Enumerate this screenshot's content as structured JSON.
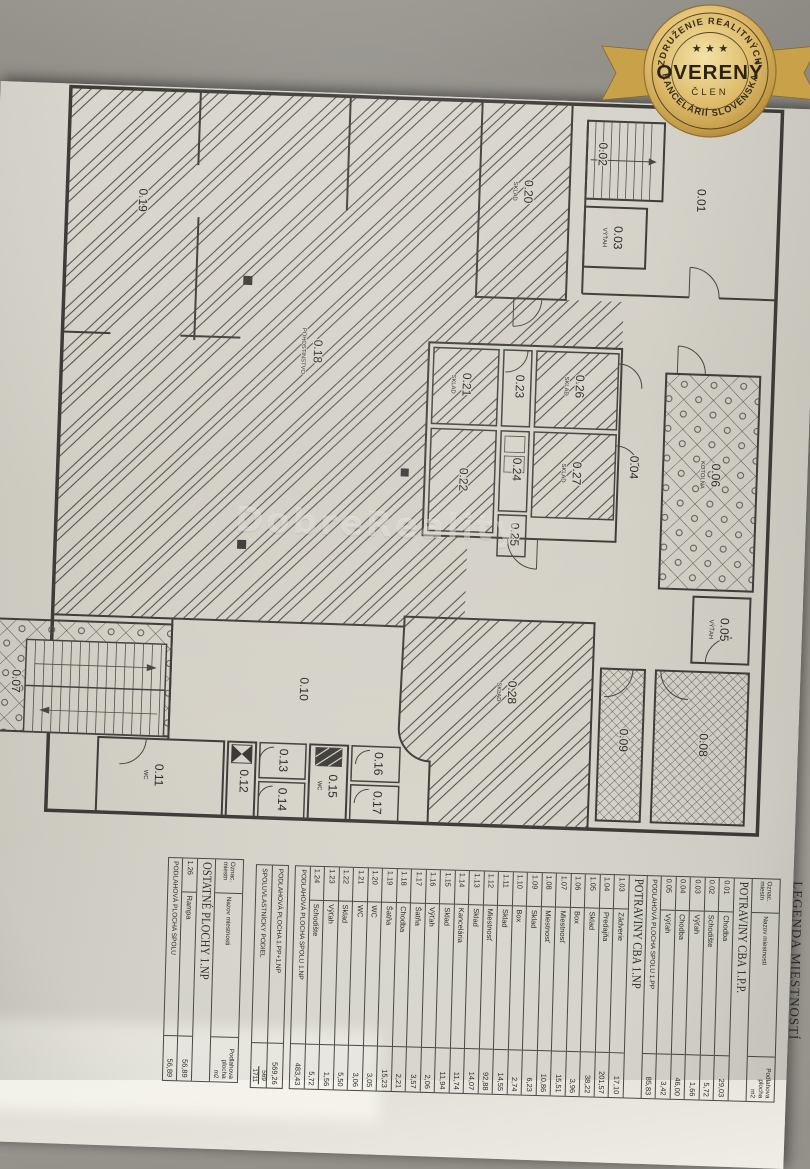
{
  "badge": {
    "arc_top": "ZDRUŽENIE REALITNÝCH",
    "stars": "★ ★ ★",
    "title": "OVERENÝ",
    "subtitle": "ČLEN",
    "arc_bottom": "KANCELÁRIÍ SLOVENSKA",
    "gold": "#d3ab56"
  },
  "watermark": "DobreReality",
  "plan": {
    "rooms": [
      {
        "label": "0.19",
        "sub": ""
      },
      {
        "label": "0.18",
        "sub": "POHOSTINSTVO"
      },
      {
        "label": "0.20",
        "sub": "SKLAD"
      },
      {
        "label": "0.02",
        "sub": ""
      },
      {
        "label": "0.03",
        "sub": "VÝŤAH"
      },
      {
        "label": "0.01",
        "sub": ""
      },
      {
        "label": "0.21",
        "sub": "SKLAD"
      },
      {
        "label": "0.23",
        "sub": ""
      },
      {
        "label": "0.26",
        "sub": "SKLAD"
      },
      {
        "label": "0.22",
        "sub": ""
      },
      {
        "label": "0.24",
        "sub": ""
      },
      {
        "label": "0.27",
        "sub": "SKLAD"
      },
      {
        "label": "0.25",
        "sub": ""
      },
      {
        "label": "0.04",
        "sub": ""
      },
      {
        "label": "0.06",
        "sub": "KOTOLŇA"
      },
      {
        "label": "0.05",
        "sub": "VÝŤAH"
      },
      {
        "label": "0.28",
        "sub": "SKLAD"
      },
      {
        "label": "0.10",
        "sub": ""
      },
      {
        "label": "0.09",
        "sub": ""
      },
      {
        "label": "0.08",
        "sub": ""
      },
      {
        "label": "0.07",
        "sub": ""
      },
      {
        "label": "0.11",
        "sub": "WC"
      },
      {
        "label": "0.12",
        "sub": ""
      },
      {
        "label": "0.13",
        "sub": ""
      },
      {
        "label": "0.14",
        "sub": ""
      },
      {
        "label": "0.15",
        "sub": "WC"
      },
      {
        "label": "0.16",
        "sub": ""
      },
      {
        "label": "0.17",
        "sub": ""
      }
    ]
  },
  "legend": {
    "title": "LEGENDA MIESTNOSTÍ",
    "headers": {
      "oznac": "Oznac.\nmiestn",
      "name": "Nazov miestnosti",
      "area": "Podlahova\nplocha\nm2"
    },
    "rows": [
      {
        "type": "section",
        "name": "POTRAVINY CBA 1.P.P."
      },
      {
        "type": "data",
        "oznac": "0.01",
        "name": "Chodba",
        "area": "29,03"
      },
      {
        "type": "data",
        "oznac": "0.02",
        "name": "Schodište",
        "area": "5,72"
      },
      {
        "type": "data",
        "oznac": "0.03",
        "name": "Výťah",
        "area": "1,66"
      },
      {
        "type": "data",
        "oznac": "0.04",
        "name": "Chodba",
        "area": "46,00"
      },
      {
        "type": "data",
        "oznac": "0.05",
        "name": "Výťah",
        "area": "3,42"
      },
      {
        "type": "total",
        "name": "PODLAHOVÁ PLOCHA SPOLU 1.PP",
        "area": "85,83"
      },
      {
        "type": "section",
        "name": "POTRAVINY CBA 1.NP"
      },
      {
        "type": "data",
        "oznac": "1.03",
        "name": "Zádverie",
        "area": "17,10"
      },
      {
        "type": "data",
        "oznac": "1.04",
        "name": "Predajňa",
        "area": "201,57"
      },
      {
        "type": "data",
        "oznac": "1.05",
        "name": "Sklad",
        "area": "38,22"
      },
      {
        "type": "data",
        "oznac": "1.06",
        "name": "Box",
        "area": "3,96"
      },
      {
        "type": "data",
        "oznac": "1.07",
        "name": "Miestnosť",
        "area": "15,51"
      },
      {
        "type": "data",
        "oznac": "1.08",
        "name": "Miestnosť",
        "area": "10,86"
      },
      {
        "type": "data",
        "oznac": "1.09",
        "name": "Sklad",
        "area": "6,23"
      },
      {
        "type": "data",
        "oznac": "1.10",
        "name": "Box",
        "area": "2,74"
      },
      {
        "type": "data",
        "oznac": "1.11",
        "name": "Sklad",
        "area": "14,55"
      },
      {
        "type": "data",
        "oznac": "1.12",
        "name": "Miestnosť",
        "area": "92,88"
      },
      {
        "type": "data",
        "oznac": "1.13",
        "name": "Sklad",
        "area": "14,07"
      },
      {
        "type": "data",
        "oznac": "1.14",
        "name": "Kancelária",
        "area": "11,74"
      },
      {
        "type": "data",
        "oznac": "1.15",
        "name": "Sklad",
        "area": "11,94"
      },
      {
        "type": "data",
        "oznac": "1.16",
        "name": "Výťah",
        "area": "2,06"
      },
      {
        "type": "data",
        "oznac": "1.17",
        "name": "Šatňa",
        "area": "3,57"
      },
      {
        "type": "data",
        "oznac": "1.18",
        "name": "Chodba",
        "area": "2,21"
      },
      {
        "type": "data",
        "oznac": "1.19",
        "name": "Šatňa",
        "area": "15,23"
      },
      {
        "type": "data",
        "oznac": "1.20",
        "name": "WC",
        "area": "3,05"
      },
      {
        "type": "data",
        "oznac": "1.21",
        "name": "WC",
        "area": "3,06"
      },
      {
        "type": "data",
        "oznac": "1.22",
        "name": "Sklad",
        "area": "5,50"
      },
      {
        "type": "data",
        "oznac": "1.23",
        "name": "Výťah",
        "area": "1,56"
      },
      {
        "type": "data",
        "oznac": "1.24",
        "name": "Schodište",
        "area": "5,72"
      },
      {
        "type": "total",
        "name": "PODLAHOVÁ PLOCHA SPOLU 1.NP",
        "area": "483,43"
      }
    ],
    "summary": [
      {
        "name": "PODLAHOVÁ PLOCHA 1.PP+1.NP",
        "area": "569,26"
      },
      {
        "name": "SPOLUVLASTNÍCKY PODIEL",
        "num": "569",
        "den": "1711"
      }
    ]
  },
  "other_table": {
    "headers": {
      "oznac": "Oznac.\nmiestn",
      "name": "Nazov miestnosti",
      "area": "Podlahova\nplocha\nm2"
    },
    "rows": [
      {
        "type": "section",
        "name": "OSTATNÉ PLOCHY 1.NP"
      },
      {
        "type": "data",
        "oznac": "1.26",
        "name": "Rampa",
        "area": "56,89"
      },
      {
        "type": "total",
        "name": "PODLAHOVÁ PLOCHA SPOLU",
        "area": "56,89"
      }
    ]
  }
}
